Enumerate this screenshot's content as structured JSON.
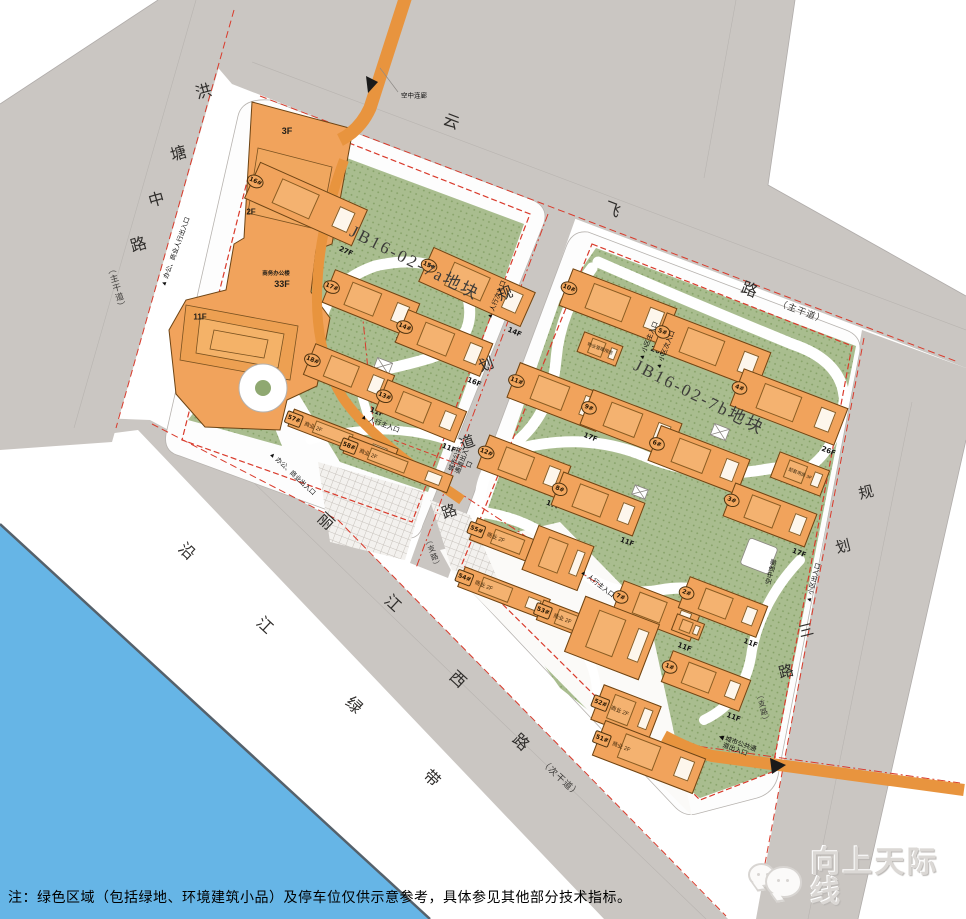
{
  "colors": {
    "road_gray": "#cac6c2",
    "parcel_white": "#fdfdfd",
    "green": "#a9bd8f",
    "building_orange": "#f1a35c",
    "bridge_orange": "#e8943e",
    "red_line": "#d93a2b",
    "river_blue": "#66b5e6"
  },
  "parcels": [
    {
      "label": "JB16-02-7a地块",
      "x": 352,
      "y": 216,
      "rot": 27,
      "size": 17
    },
    {
      "label": "JB16-02-7b地块",
      "x": 636,
      "y": 350,
      "rot": 27,
      "size": 17
    }
  ],
  "roads": [
    {
      "name": "洪塘中路",
      "type": "（主干道）",
      "size": 16,
      "rot": -16,
      "chars": [
        [
          "洪",
          203,
          90
        ],
        [
          "塘",
          178,
          152
        ],
        [
          "中",
          156,
          198
        ],
        [
          "路",
          138,
          243
        ]
      ],
      "type_pos": {
        "x": 117,
        "y": 288,
        "rot": -16,
        "s": 8.5,
        "vertical": true
      }
    },
    {
      "name": "云飞路",
      "type": "（主干道）",
      "size": 16,
      "rot": 21,
      "chars": [
        [
          "云",
          452,
          120
        ],
        [
          "飞",
          613,
          208
        ],
        [
          "路",
          750,
          288
        ]
      ],
      "type_pos": {
        "x": 802,
        "y": 311,
        "rot": 21,
        "s": 9,
        "vertical": false
      }
    },
    {
      "name": "规划道路",
      "type": "（支路）",
      "size": 15,
      "rot": -20,
      "chars": [
        [
          "规",
          505,
          293
        ],
        [
          "划",
          486,
          364
        ],
        [
          "道",
          467,
          442
        ],
        [
          "路",
          449,
          511
        ]
      ],
      "type_pos": {
        "x": 433,
        "y": 553,
        "rot": -20,
        "s": 7.5,
        "vertical": true
      }
    },
    {
      "name": "规划三路",
      "type": "（支路）",
      "size": 15,
      "rot": -14,
      "chars": [
        [
          "规",
          866,
          492
        ],
        [
          "划",
          843,
          546
        ],
        [
          "三",
          806,
          630
        ],
        [
          "路",
          786,
          671
        ]
      ],
      "type_pos": {
        "x": 763,
        "y": 708,
        "rot": -14,
        "s": 7.5,
        "vertical": true
      }
    },
    {
      "name": "丽江西路",
      "type": "（次干道）",
      "size": 16,
      "rot": 43,
      "chars": [
        [
          "丽",
          327,
          520
        ],
        [
          "江",
          394,
          602
        ],
        [
          "西",
          459,
          678
        ],
        [
          "路",
          522,
          741
        ]
      ],
      "type_pos": {
        "x": 561,
        "y": 778,
        "rot": 43,
        "s": 9,
        "vertical": false
      }
    },
    {
      "name": "沿江绿带",
      "type": "",
      "size": 16,
      "rot": 43,
      "chars": [
        [
          "沿",
          188,
          550
        ],
        [
          "江",
          266,
          624
        ],
        [
          "绿",
          355,
          704
        ],
        [
          "带",
          433,
          777
        ]
      ],
      "type_pos": null
    }
  ],
  "blocks": {
    "residential": [
      {
        "id": "16#",
        "fl": "27F",
        "x": 306,
        "y": 204,
        "w": 118,
        "h": 40,
        "r": 24
      },
      {
        "id": "15#",
        "fl": "14F",
        "x": 477,
        "y": 287,
        "w": 112,
        "h": 38,
        "r": 24
      },
      {
        "id": "17#",
        "fl": "16F",
        "x": 371,
        "y": 303,
        "w": 92,
        "h": 36,
        "r": 22
      },
      {
        "id": "14#",
        "fl": "16F",
        "x": 444,
        "y": 343,
        "w": 92,
        "h": 36,
        "r": 22
      },
      {
        "id": "18#",
        "fl": "11F",
        "x": 349,
        "y": 375,
        "w": 86,
        "h": 34,
        "r": 22
      },
      {
        "id": "13#",
        "fl": "11F",
        "x": 421,
        "y": 411,
        "w": 86,
        "h": 34,
        "r": 22
      },
      {
        "id": "10#",
        "fl": "26F",
        "x": 618,
        "y": 307,
        "w": 112,
        "h": 40,
        "r": 21
      },
      {
        "id": "5#",
        "fl": "26F",
        "x": 712,
        "y": 351,
        "w": 112,
        "h": 40,
        "r": 21
      },
      {
        "id": "4#",
        "fl": "26F",
        "x": 789,
        "y": 407,
        "w": 112,
        "h": 40,
        "r": 21
      },
      {
        "id": "11#",
        "fl": "17F",
        "x": 558,
        "y": 397,
        "w": 96,
        "h": 38,
        "r": 21
      },
      {
        "id": "9#",
        "fl": "17F",
        "x": 631,
        "y": 424,
        "w": 96,
        "h": 38,
        "r": 21
      },
      {
        "id": "6#",
        "fl": "17F",
        "x": 699,
        "y": 460,
        "w": 96,
        "h": 38,
        "r": 21
      },
      {
        "id": "12#",
        "fl": "17F",
        "x": 524,
        "y": 467,
        "w": 88,
        "h": 36,
        "r": 21
      },
      {
        "id": "8#",
        "fl": "11F",
        "x": 598,
        "y": 504,
        "w": 88,
        "h": 36,
        "r": 21
      },
      {
        "id": "3#",
        "fl": "17F",
        "x": 770,
        "y": 515,
        "w": 88,
        "h": 36,
        "r": 21
      },
      {
        "id": "7#",
        "fl": "11F",
        "x": 657,
        "y": 611,
        "w": 84,
        "h": 34,
        "r": 21
      },
      {
        "id": "2#",
        "fl": "11F",
        "x": 723,
        "y": 607,
        "w": 84,
        "h": 34,
        "r": 21
      },
      {
        "id": "1#",
        "fl": "11F",
        "x": 706,
        "y": 681,
        "w": 84,
        "h": 34,
        "r": 21
      }
    ],
    "commercial": [
      {
        "id": "57#",
        "use": "商业 2F",
        "x": 343,
        "y": 437,
        "w": 112,
        "h": 19,
        "r": 21
      },
      {
        "id": "58#",
        "use": "商业 2F",
        "x": 398,
        "y": 464,
        "w": 112,
        "h": 19,
        "r": 21
      },
      {
        "id": "55#",
        "use": "商业 2F",
        "x": 516,
        "y": 545,
        "w": 92,
        "h": 24,
        "r": 21
      },
      {
        "id": "54#",
        "use": "商业 2F",
        "x": 504,
        "y": 593,
        "w": 92,
        "h": 22,
        "r": 21
      },
      {
        "id": "53#",
        "use": "商业 2F",
        "x": 577,
        "y": 624,
        "w": 80,
        "h": 22,
        "r": 21
      },
      {
        "id": "52#",
        "use": "商业 2F",
        "x": 626,
        "y": 713,
        "w": 62,
        "h": 38,
        "r": 21
      },
      {
        "id": "51#",
        "use": "商业 2F",
        "x": 649,
        "y": 757,
        "w": 108,
        "h": 38,
        "r": 21
      }
    ],
    "ancillary": [
      {
        "label": "物业管理用房",
        "x": 600,
        "y": 349,
        "w": 42,
        "h": 22,
        "r": 21
      },
      {
        "label": "配套用房 3F",
        "x": 800,
        "y": 474,
        "w": 54,
        "h": 28,
        "r": 21
      },
      {
        "label": "",
        "x": 688,
        "y": 627,
        "w": 30,
        "h": 18,
        "r": 21
      },
      {
        "label": "",
        "x": 558,
        "y": 558,
        "w": 60,
        "h": 48,
        "r": 21
      },
      {
        "label": "",
        "x": 612,
        "y": 638,
        "w": 80,
        "h": 60,
        "r": 21
      }
    ],
    "office_labels": [
      {
        "t": "3F",
        "x": 287,
        "y": 131,
        "s": 9
      },
      {
        "t": "2F",
        "x": 251,
        "y": 212,
        "s": 8
      },
      {
        "t": "商务办公楼",
        "x": 276,
        "y": 273,
        "s": 5.5
      },
      {
        "t": "33F",
        "x": 282,
        "y": 284,
        "s": 9
      },
      {
        "t": "11F",
        "x": 200,
        "y": 317,
        "s": 8
      }
    ]
  },
  "entrances": [
    {
      "t": "▲ 办公、商业人行出入口",
      "x": 176,
      "y": 252,
      "r": -70
    },
    {
      "t": "▲ 办公、商业出入口",
      "x": 292,
      "y": 474,
      "r": 43
    },
    {
      "t": "▲ 人行主入口",
      "x": 380,
      "y": 424,
      "r": 21
    },
    {
      "t": "▲ 人行主入口",
      "x": 597,
      "y": 584,
      "r": 38
    },
    {
      "t": "▲ 人行次入口",
      "x": 497,
      "y": 300,
      "r": -68
    },
    {
      "t": "▲ 小区主入口",
      "x": 649,
      "y": 341,
      "r": -68
    },
    {
      "t": "▲ 小区次入口",
      "x": 666,
      "y": 350,
      "r": -68
    },
    {
      "t": "城市公共通道出入口",
      "x": 463,
      "y": 462,
      "r": -68,
      "w": 30
    },
    {
      "t": "◀ 城市公共通道出入口",
      "x": 736,
      "y": 747,
      "r": 20,
      "w": 40
    },
    {
      "t": "▲ 小区出入口",
      "x": 814,
      "y": 583,
      "r": -75
    },
    {
      "t": "空中连廊",
      "x": 414,
      "y": 96,
      "r": 0
    },
    {
      "t": "空中连廊",
      "x": 772,
      "y": 572,
      "r": -75
    }
  ],
  "note": "注：绿色区域（包括绿地、环境建筑小品）及停车位仅供示意参考，具体参见其他部分技术指标。",
  "watermark": "向上天际线"
}
